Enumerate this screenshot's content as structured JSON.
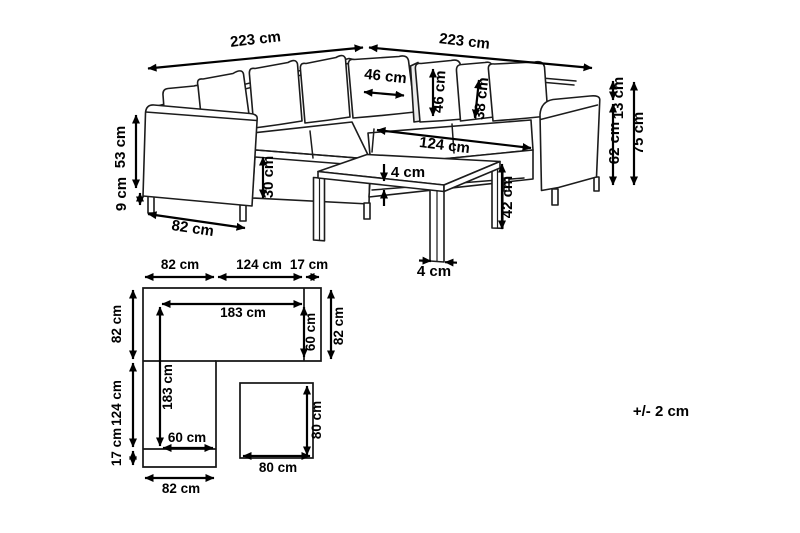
{
  "sofa_view": {
    "back_left_length": "223 cm",
    "back_right_length": "223 cm",
    "corner_pillow_width": "46 cm",
    "pillow_height": "46 cm",
    "small_pillow_height": "38 cm",
    "seat_length": "124 cm",
    "back_above_armrest_height": "13 cm",
    "armrest_top_height": "62 cm",
    "total_height": "75 cm",
    "armrest_side_height": "53 cm",
    "leg_height": "9 cm",
    "seat_front_height": "30 cm",
    "armrest_depth": "82 cm"
  },
  "table_view": {
    "top_thickness": "4 cm",
    "leg_height": "42 cm",
    "leg_width": "4 cm"
  },
  "floor_plan": {
    "top_armrest_width": "82 cm",
    "top_seat_width": "124 cm",
    "top_side_width": "17 cm",
    "left_top_depth": "82 cm",
    "left_seat_depth": "124 cm",
    "left_bottom_depth": "17 cm",
    "inner_width": "183 cm",
    "inner_depth": "183 cm",
    "right_seat_depth": "60 cm",
    "bottom_seat_width": "60 cm",
    "right_side_depth": "82 cm",
    "bottom_width": "82 cm"
  },
  "table_plan": {
    "width": "80 cm",
    "depth": "80 cm"
  },
  "tolerance_note": "+/- 2 cm"
}
